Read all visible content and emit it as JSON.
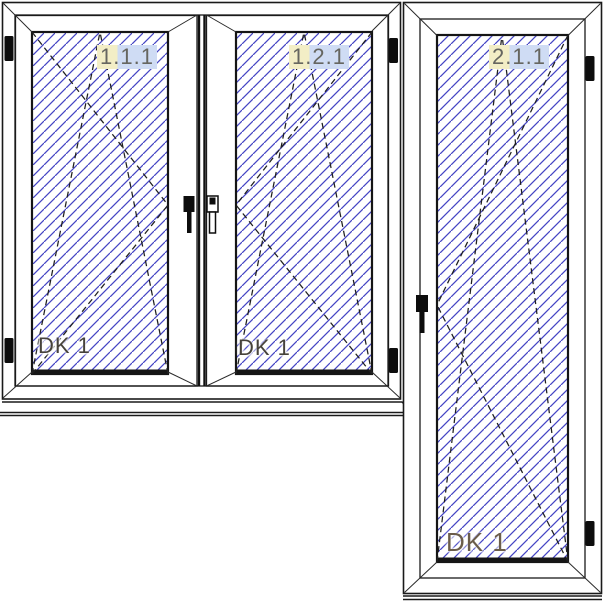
{
  "elements": {
    "left_window_sash": {
      "position_label": "1.1.1",
      "opening_type": "DK 1"
    },
    "middle_window_sash": {
      "position_label": "1.2.1",
      "opening_type": "DK 1"
    },
    "balcony_door": {
      "position_label": "2.1.1",
      "opening_type": "DK 1"
    }
  },
  "colors": {
    "hatch_blue": "#4444c4",
    "outline_black": "#1a1a1a",
    "label_text_gray": "#666660",
    "dk_text_dark": "#46423b",
    "dk_text_door": "#6b5d4a",
    "label_highlight_yellow": "#f3eec6",
    "label_highlight_blue": "#cfdcf4",
    "background_white": "#ffffff"
  }
}
